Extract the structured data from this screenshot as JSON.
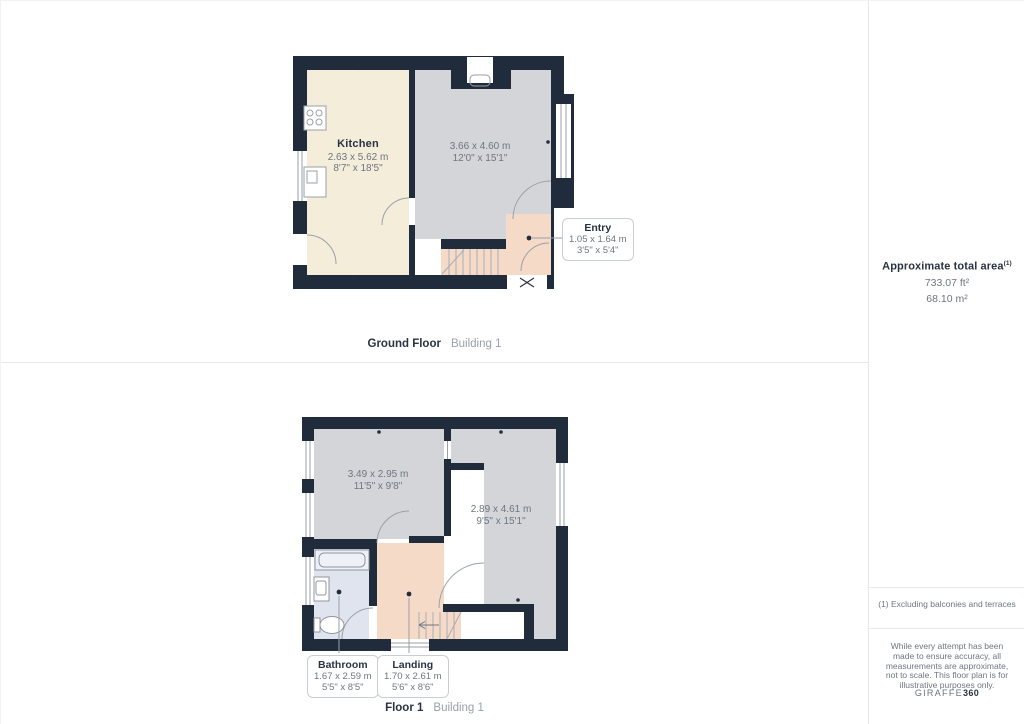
{
  "colors": {
    "wall": "#202b3c",
    "kitchen": "#f4edda",
    "room": "#d3d5d8",
    "entry": "#f6dac8",
    "bathroom": "#dfe4ef",
    "white": "#ffffff"
  },
  "ground_floor": {
    "rooms": {
      "kitchen": {
        "name": "Kitchen",
        "metric": "2.63 x 5.62 m",
        "imperial": "8'7\" x 18'5\""
      },
      "living": {
        "metric": "3.66 x 4.60 m",
        "imperial": "12'0\" x 15'1\""
      },
      "entry": {
        "name": "Entry",
        "metric": "1.05 x 1.64 m",
        "imperial": "3'5\" x 5'4\""
      }
    },
    "footer": {
      "floor": "Ground Floor",
      "building": "Building 1"
    }
  },
  "floor_1": {
    "rooms": {
      "room_a": {
        "metric": "3.49 x 2.95 m",
        "imperial": "11'5\" x 9'8\""
      },
      "room_b": {
        "metric": "2.89 x 4.61 m",
        "imperial": "9'5\" x 15'1\""
      },
      "bathroom": {
        "name": "Bathroom",
        "metric": "1.67 x 2.59 m",
        "imperial": "5'5\" x 8'5\""
      },
      "landing": {
        "name": "Landing",
        "metric": "1.70 x 2.61 m",
        "imperial": "5'6\" x 8'6\""
      }
    },
    "footer": {
      "floor": "Floor 1",
      "building": "Building 1"
    }
  },
  "sidebar": {
    "area_title": "Approximate total area",
    "area_sup": "(1)",
    "area_sqft": "733.07 ft²",
    "area_sqm": "68.10 m²",
    "footnote": "(1) Excluding balconies and terraces",
    "disclaimer": "While every attempt has been made to ensure accuracy, all measurements are approximate, not to scale. This floor plan is for illustrative purposes only.",
    "logo_name": "GIRAFFE",
    "logo_number": "360"
  }
}
